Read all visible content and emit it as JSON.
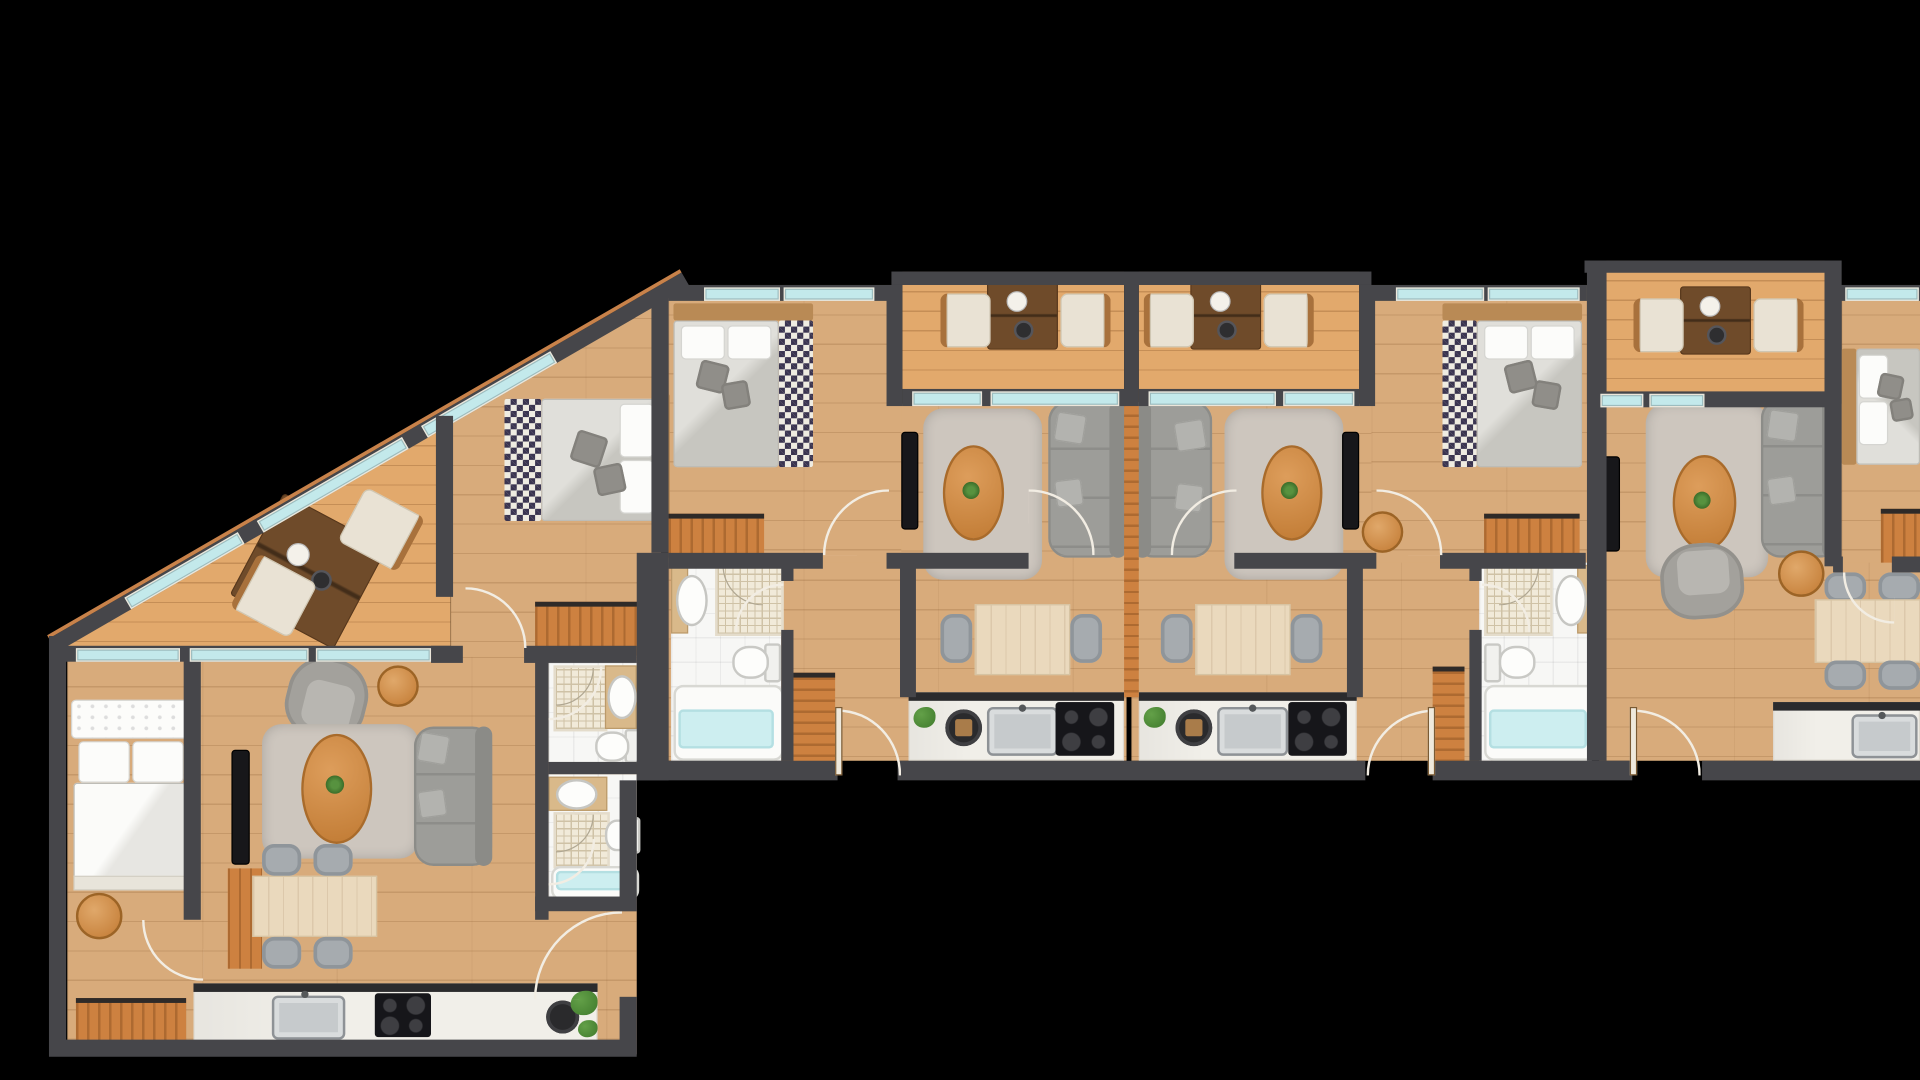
{
  "title": "residential-floor-plan",
  "background_color": "#000000",
  "palette": {
    "wall": "#46464a",
    "wood_floor": "#d8ab7b",
    "balcony_floor": "#e2a96c",
    "furniture_wood": "#cd8140",
    "walnut_table": "#6f4b2a",
    "light_table_wood": "#ead9bd",
    "counter_white": "#f1efe9",
    "counter_edge": "#2b2b2d",
    "steel_sink": "#c6cacc",
    "cooktop_black": "#16161a",
    "sofa_gray": "#9d9d99",
    "rug_gray": "#cdc6be",
    "bed_linen": "#dedddb",
    "checker_navy": "#3a3450",
    "window_glass": "#c3e9eb",
    "window_frame_wood": "#c8824a",
    "bath_tile": "#f7f7f5",
    "shower_tile": "#cfc2a6",
    "tub_glass": "#cdeef0",
    "plant_green": "#4c8a38",
    "tv_black": "#17171a",
    "door_arc": "#f2ede3"
  },
  "units": [
    {
      "name": "corner-apartment-west",
      "rooms": [
        "triangular-terrace",
        "bedroom-1",
        "bedroom-2",
        "living-dining-room",
        "kitchen",
        "bathroom-1",
        "bathroom-2",
        "entry-hall"
      ],
      "furniture": [
        "terrace-coffee-table",
        "terrace-chair",
        "terrace-chair",
        "double-bed-checkered",
        "dresser",
        "double-bed-white",
        "ottoman",
        "wardrobe",
        "tv",
        "tv-cabinet",
        "armchair",
        "side-table",
        "rug",
        "oval-coffee-table",
        "sofa",
        "dining-table",
        "dining-chairs-4",
        "kitchen-counter",
        "kitchen-sink",
        "cooktop",
        "round-basin",
        "plants",
        "washbasins",
        "showers",
        "toilets",
        "bathtub"
      ]
    },
    {
      "name": "middle-apartment-west",
      "rooms": [
        "balcony",
        "bedroom",
        "living-room",
        "dining-area",
        "kitchen",
        "bathroom",
        "hallway"
      ],
      "furniture": [
        "balcony-desk",
        "desk-chairs-2",
        "double-bed-checkered",
        "dresser",
        "tv",
        "rug",
        "oval-coffee-table",
        "sofa",
        "dining-table",
        "dining-chairs-2",
        "kitchen-counter",
        "kitchen-sink",
        "cooktop",
        "cutting-board",
        "plant",
        "wardrobe",
        "washbasin",
        "shower",
        "toilet",
        "bathtub"
      ]
    },
    {
      "name": "middle-apartment-east",
      "rooms": [
        "balcony",
        "bedroom",
        "living-room",
        "dining-area",
        "kitchen",
        "bathroom",
        "hallway"
      ],
      "furniture": [
        "balcony-desk",
        "desk-chairs-2",
        "double-bed-checkered",
        "dresser",
        "tv",
        "rug",
        "oval-coffee-table",
        "sofa",
        "dining-table",
        "dining-chairs-2",
        "kitchen-counter",
        "kitchen-sink",
        "cooktop",
        "cutting-board",
        "plant",
        "wardrobe",
        "side-table",
        "washbasin",
        "shower",
        "toilet",
        "bathtub"
      ]
    },
    {
      "name": "end-apartment-east",
      "rooms": [
        "balcony",
        "bedroom",
        "living-room",
        "dining-area",
        "kitchen",
        "entry-hall"
      ],
      "furniture": [
        "balcony-desk",
        "desk-chairs-2",
        "double-bed",
        "wardrobe",
        "tv",
        "rug",
        "oval-coffee-table",
        "sofa",
        "armchair",
        "side-table",
        "dining-table",
        "dining-chairs-4",
        "kitchen-counter",
        "kitchen-sink"
      ]
    }
  ]
}
